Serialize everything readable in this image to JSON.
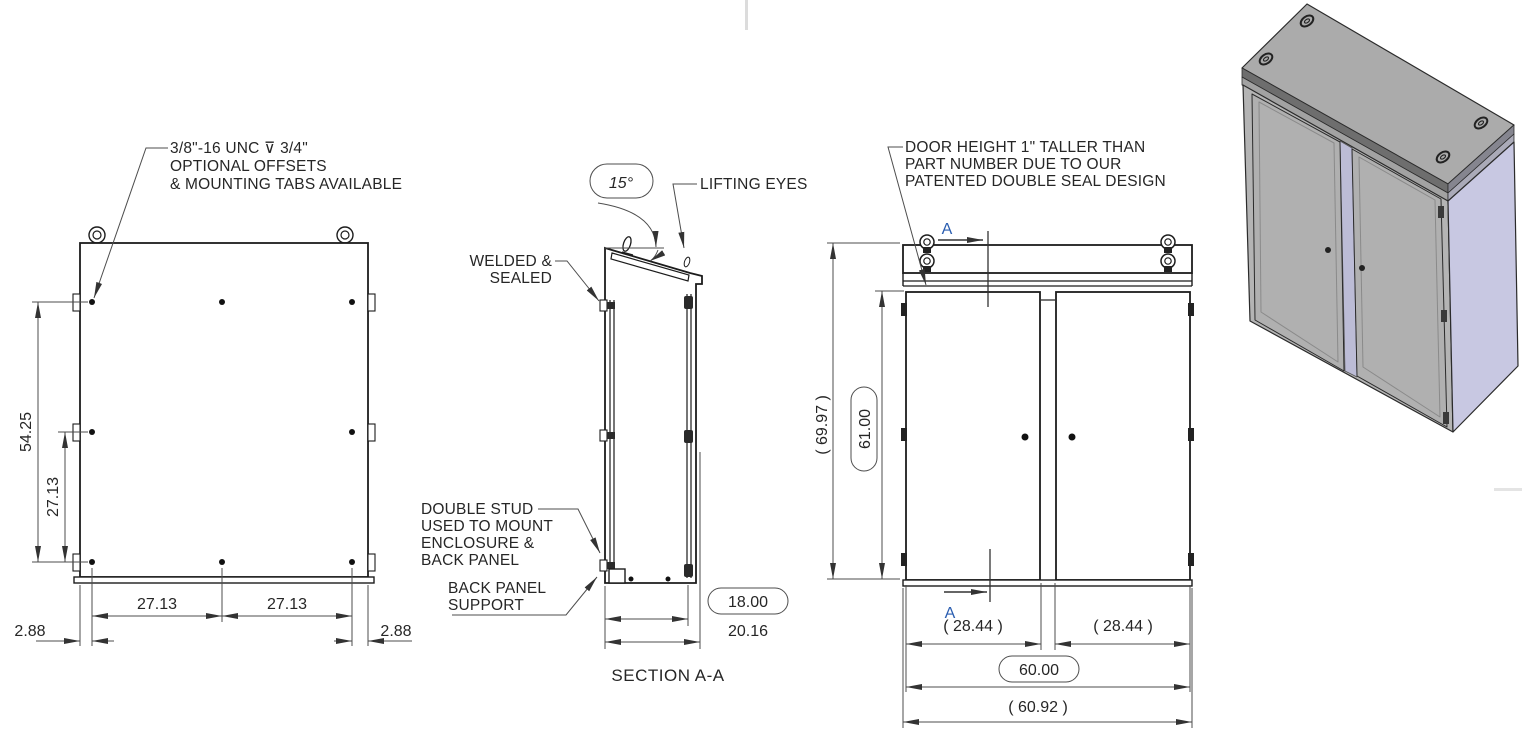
{
  "colors": {
    "line": "#1c1c1c",
    "dim_line": "#4d4d4d",
    "section_label": "#2a5db0",
    "iso_roof": "#ababab",
    "iso_body": "#b4b4b4",
    "iso_door": "#b0b0b0",
    "iso_side_panel": "#c8c8e2"
  },
  "rear_view": {
    "note": {
      "line1": "3/8\"-16 UNC ⊽ 3/4\"",
      "line2": "OPTIONAL OFFSETS",
      "line3": "& MOUNTING TABS AVAILABLE"
    },
    "dims": {
      "height_overall": "54.25",
      "height_mid": "27.13",
      "offset_left": "2.88",
      "span_left": "27.13",
      "span_right": "27.13",
      "offset_right": "2.88"
    }
  },
  "section_view": {
    "angle_dim": "15°",
    "lifting_eyes_label": "LIFTING EYES",
    "welded_label": {
      "line1": "WELDED &",
      "line2": "SEALED"
    },
    "double_stud_label": {
      "line1": "DOUBLE STUD",
      "line2": "USED TO MOUNT",
      "line3": "ENCLOSURE &",
      "line4": "BACK PANEL"
    },
    "back_panel_support_label": {
      "line1": "BACK PANEL",
      "line2": "SUPPORT"
    },
    "dims": {
      "depth_inner": "18.00",
      "depth_overall": "20.16"
    },
    "caption": "SECTION A-A"
  },
  "front_view": {
    "note": {
      "line1": "DOOR HEIGHT 1\" TALLER THAN",
      "line2": "PART NUMBER DUE TO OUR",
      "line3": "PATENTED DOUBLE SEAL DESIGN"
    },
    "section_label_top": "A",
    "section_label_bottom": "A",
    "dims": {
      "height_overall": "( 69.97 )",
      "door_height": "61.00",
      "door_width_left": "( 28.44 )",
      "door_width_right": "( 28.44 )",
      "width": "60.00",
      "width_overall": "( 60.92 )"
    }
  }
}
